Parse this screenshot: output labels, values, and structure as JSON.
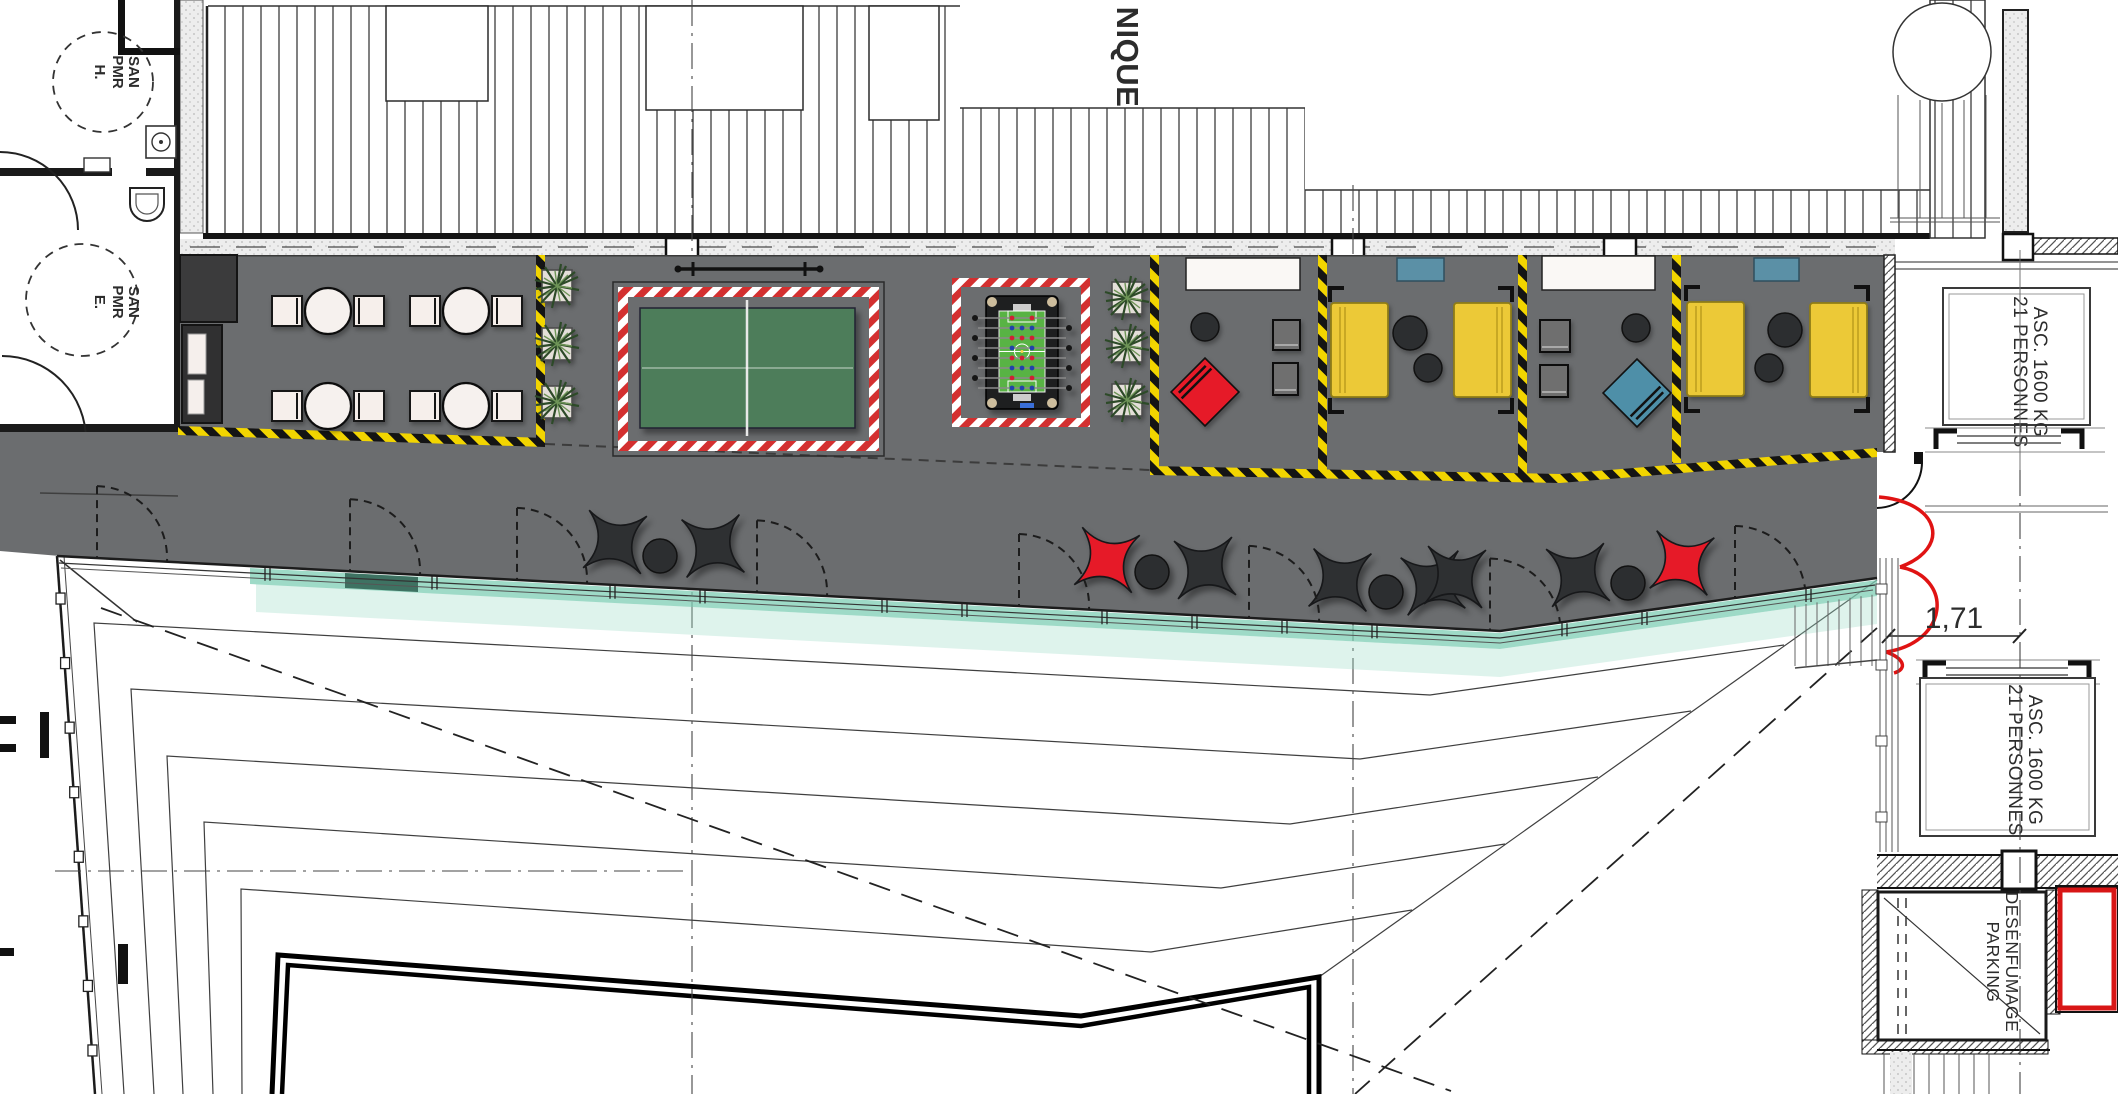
{
  "labels": {
    "room_top": {
      "line1": "SAN",
      "line2": "PMR",
      "line3": "H."
    },
    "room_bottom": {
      "line1": "SAN",
      "line2": "PMR",
      "line3": "E."
    },
    "building": {
      "partial_word": "NIQUE"
    },
    "elevator": {
      "line1": "ASC. 1600 KG",
      "line2": "21 PERSONNES"
    },
    "smoke_vent": {
      "line1": "DESENFUMAGE",
      "line2": "PARKING"
    },
    "dimension": "1,71"
  },
  "colors": {
    "terrace_gray": "#6b6d6f",
    "hazard_yellow": "#f2d500",
    "safety_red_white": "#d33030",
    "ping_pong_green": "#4d7d5a",
    "foosball_pitch_green": "#58b344",
    "armchair_yellow": "#ecc937",
    "pouf_red": "#e61a28",
    "pouf_blue": "#4e8fa8",
    "glass_teal": "#7ecdb4",
    "dark_furniture": "#2e3032"
  },
  "furniture_inventory": {
    "cafe_table_sets": 4,
    "ping_pong_tables": 1,
    "foosball_tables": 1,
    "yellow_armchairs": 4,
    "white_benches": 2,
    "blue_side_benches": 2,
    "gray_ottomans": 4,
    "red_diamond_poufs": 1,
    "blue_diamond_poufs": 1,
    "red_fabric_poufs": 2,
    "black_fabric_poufs": 6,
    "round_side_tables": 10,
    "palm_planters": 6,
    "door_swings": 8,
    "elevators": 2
  }
}
